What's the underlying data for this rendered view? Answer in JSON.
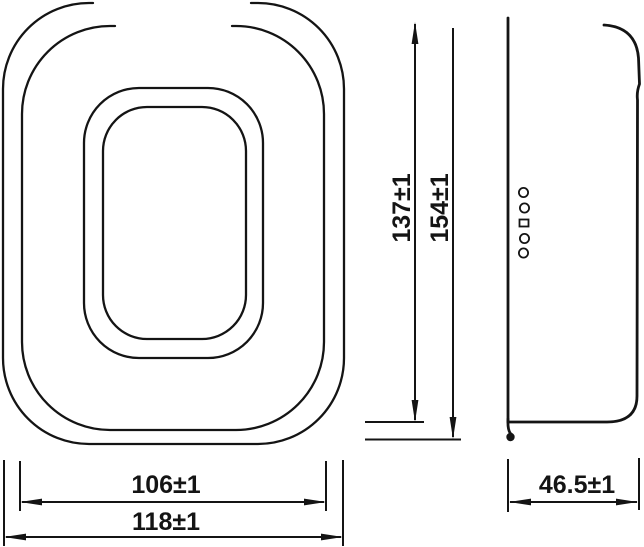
{
  "drawing": {
    "background_color": "#ffffff",
    "line_color": "#141414",
    "dimensions": {
      "inner_height_label": "137±1",
      "outer_height_label": "154±1",
      "inner_width_label": "106±1",
      "outer_width_label": "118±1",
      "depth_label": "46.5±1"
    }
  }
}
